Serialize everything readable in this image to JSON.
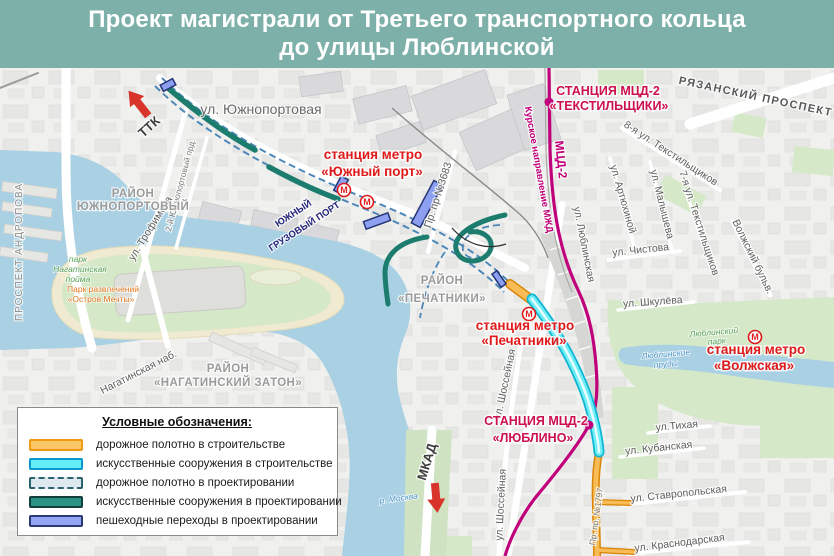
{
  "header": {
    "title_line1": "Проект магистрали от Третьего транспортного кольца",
    "title_line2": "до улицы Люблинской",
    "bg_color": "#7db0a9",
    "text_color": "#ffffff"
  },
  "legend": {
    "title": "Условные обозначения:",
    "items": [
      {
        "label": "дорожное полотно в строительстве",
        "fill": "#fbc868",
        "border": "#ef9913",
        "style": "solid"
      },
      {
        "label": "искусственные сооружения в строительстве",
        "fill": "#66eef8",
        "border": "#0a99cf",
        "style": "solid"
      },
      {
        "label": "дорожное полотно в проектировании",
        "fill": "#dde8ef",
        "border": "#2a6271",
        "style": "dashed"
      },
      {
        "label": "искусственные сооружения в проектировании",
        "fill": "#2b9384",
        "border": "#113f3a",
        "style": "solid"
      },
      {
        "label": "пешеходные переходы в проектировании",
        "fill": "#93a5f3",
        "border": "#2a3a74",
        "style": "solid"
      }
    ]
  },
  "map": {
    "colors": {
      "water": "#a9d0e3",
      "park": "#d5e8c8",
      "sand": "#f0ead0",
      "land": "#f0f1ee",
      "railway_mcd": "#c0007a",
      "metro_red": "#e01a1a",
      "mcd_label": "#cc1050",
      "construction_road": "#f8bb55",
      "construction_struct": "#6feef6",
      "design_struct": "#1c7c6e",
      "design_road_dash": "#4d87b8",
      "ped_crossing": "#8d9ff0",
      "arrow_red": "#d8342a"
    },
    "labels": [
      {
        "text": "ул. Южнопортовая",
        "x": 261,
        "y": 114,
        "rot": 0,
        "cls": "street-lg"
      },
      {
        "text": "станция метро",
        "x": 373,
        "y": 159,
        "rot": 0,
        "cls": "metro"
      },
      {
        "text": "«Южный порт»",
        "x": 372,
        "y": 176,
        "rot": 0,
        "cls": "metro"
      },
      {
        "text": "ЮЖНЫЙ",
        "x": 295,
        "y": 216,
        "rot": -33,
        "cls": "port"
      },
      {
        "text": "ГРУЗОВЫЙ ПОРТ",
        "x": 306,
        "y": 229,
        "rot": -33,
        "cls": "port"
      },
      {
        "text": "Пр. пр №3683",
        "x": 441,
        "y": 196,
        "rot": -72,
        "cls": "street"
      },
      {
        "text": "ТТК",
        "x": 152,
        "y": 130,
        "rot": -42,
        "cls": "arrowlbl"
      },
      {
        "text": "ул. Трофимова",
        "x": 153,
        "y": 230,
        "rot": -58,
        "cls": "street"
      },
      {
        "text": "2-й Южнопортовый прд.",
        "x": 183,
        "y": 186,
        "rot": -75,
        "cls": "street-sm"
      },
      {
        "text": "РАЙОН",
        "x": 133,
        "y": 197,
        "rot": 0,
        "cls": "district"
      },
      {
        "text": "ЮЖНОПОРТОВЫЙ",
        "x": 133,
        "y": 210,
        "rot": 0,
        "cls": "district"
      },
      {
        "text": "ПРОСПЕКТ АНДРОПОВА",
        "x": 22,
        "y": 252,
        "rot": -90,
        "cls": "district-sm"
      },
      {
        "text": "парк",
        "x": 78,
        "y": 262,
        "rot": 0,
        "cls": "park"
      },
      {
        "text": "Нагатинская",
        "x": 80,
        "y": 272,
        "rot": 0,
        "cls": "park"
      },
      {
        "text": "пойма",
        "x": 78,
        "y": 282,
        "rot": 0,
        "cls": "park"
      },
      {
        "text": "Парк развлечений",
        "x": 103,
        "y": 292,
        "rot": 0,
        "cls": "attr"
      },
      {
        "text": "«Остров Мечты»",
        "x": 101,
        "y": 302,
        "rot": 0,
        "cls": "attr"
      },
      {
        "text": "Нагатинская наб.",
        "x": 140,
        "y": 375,
        "rot": -27,
        "cls": "street"
      },
      {
        "text": "РАЙОН",
        "x": 228,
        "y": 372,
        "rot": 0,
        "cls": "district"
      },
      {
        "text": "«НАГАТИНСКИЙ ЗАТОН»",
        "x": 228,
        "y": 386,
        "rot": 0,
        "cls": "district"
      },
      {
        "text": "РАЙОН",
        "x": 442,
        "y": 284,
        "rot": 0,
        "cls": "district"
      },
      {
        "text": "«ПЕЧАТНИКИ»",
        "x": 442,
        "y": 302,
        "rot": 0,
        "cls": "district"
      },
      {
        "text": "станция метро",
        "x": 525,
        "y": 330,
        "rot": 0,
        "cls": "metro"
      },
      {
        "text": "«Печатники»",
        "x": 524,
        "y": 345,
        "rot": 0,
        "cls": "metro"
      },
      {
        "text": "ул. Шоссейная",
        "x": 508,
        "y": 385,
        "rot": -78,
        "cls": "street"
      },
      {
        "text": "ул. Шоссейная",
        "x": 504,
        "y": 505,
        "rot": -87,
        "cls": "street"
      },
      {
        "text": "СТАНЦИЯ МЦД-2",
        "x": 536,
        "y": 425,
        "rot": 0,
        "cls": "mcd"
      },
      {
        "text": "«ЛЮБЛИНО»",
        "x": 533,
        "y": 442,
        "rot": 0,
        "cls": "mcd"
      },
      {
        "text": "МКАД",
        "x": 431,
        "y": 463,
        "rot": -73,
        "cls": "arrowlbl"
      },
      {
        "text": "р. Москва",
        "x": 399,
        "y": 501,
        "rot": -8,
        "cls": "water"
      },
      {
        "text": "Пр. пр. №1797",
        "x": 599,
        "y": 517,
        "rot": -82,
        "cls": "street-sm"
      },
      {
        "text": "ул.Тихая",
        "x": 677,
        "y": 429,
        "rot": -5,
        "cls": "street"
      },
      {
        "text": "ул. Кубанская",
        "x": 659,
        "y": 451,
        "rot": -6,
        "cls": "street"
      },
      {
        "text": "ул. Ставропольская",
        "x": 679,
        "y": 497,
        "rot": -6,
        "cls": "street"
      },
      {
        "text": "ул. Краснодарская",
        "x": 680,
        "y": 546,
        "rot": -7,
        "cls": "street"
      },
      {
        "text": "СТАНЦИЯ МЦД-2",
        "x": 608,
        "y": 95,
        "rot": 0,
        "cls": "mcd"
      },
      {
        "text": "«ТЕКСТИЛЬЩИКИ»",
        "x": 609,
        "y": 110,
        "rot": 0,
        "cls": "mcd"
      },
      {
        "text": "РЯЗАНСКИЙ ПРОСПЕКТ",
        "x": 755,
        "y": 100,
        "rot": 12,
        "cls": "avenue"
      },
      {
        "text": "Курское направление МЖД",
        "x": 536,
        "y": 170,
        "rot": 80,
        "cls": "rail"
      },
      {
        "text": "МЦД-2",
        "x": 557,
        "y": 160,
        "rot": 84,
        "cls": "rail-lg"
      },
      {
        "text": "8-я ул. Текстильщиков",
        "x": 669,
        "y": 156,
        "rot": 33,
        "cls": "street"
      },
      {
        "text": "ул. Артюхиной",
        "x": 620,
        "y": 200,
        "rot": 74,
        "cls": "street"
      },
      {
        "text": "ул. Малышева",
        "x": 659,
        "y": 205,
        "rot": 76,
        "cls": "street"
      },
      {
        "text": "7-я ул. Текстильщиков",
        "x": 696,
        "y": 224,
        "rot": 72,
        "cls": "street"
      },
      {
        "text": "Волжский бульв.",
        "x": 750,
        "y": 258,
        "rot": 64,
        "cls": "street"
      },
      {
        "text": "ул. Чистова",
        "x": 641,
        "y": 253,
        "rot": -6,
        "cls": "street"
      },
      {
        "text": "ул. Шкулёва",
        "x": 653,
        "y": 305,
        "rot": -4,
        "cls": "street"
      },
      {
        "text": "ул. Люблинская",
        "x": 581,
        "y": 245,
        "rot": 79,
        "cls": "street"
      },
      {
        "text": "Люблинский",
        "x": 714,
        "y": 335,
        "rot": -5,
        "cls": "park"
      },
      {
        "text": "парк",
        "x": 717,
        "y": 344,
        "rot": -5,
        "cls": "park"
      },
      {
        "text": "Люблинские",
        "x": 666,
        "y": 357,
        "rot": -5,
        "cls": "water"
      },
      {
        "text": "пруды",
        "x": 666,
        "y": 367,
        "rot": -5,
        "cls": "water"
      },
      {
        "text": "станция метро",
        "x": 756,
        "y": 354,
        "rot": 0,
        "cls": "metro"
      },
      {
        "text": "«Волжская»",
        "x": 754,
        "y": 370,
        "rot": 0,
        "cls": "metro"
      }
    ],
    "metro_icons": [
      {
        "x": 344,
        "y": 190
      },
      {
        "x": 367,
        "y": 202
      },
      {
        "x": 529,
        "y": 314
      },
      {
        "x": 755,
        "y": 337
      }
    ],
    "metro_icon_letter": "М",
    "station_dots": [
      {
        "x": 549,
        "y": 102
      },
      {
        "x": 589,
        "y": 425
      }
    ]
  }
}
